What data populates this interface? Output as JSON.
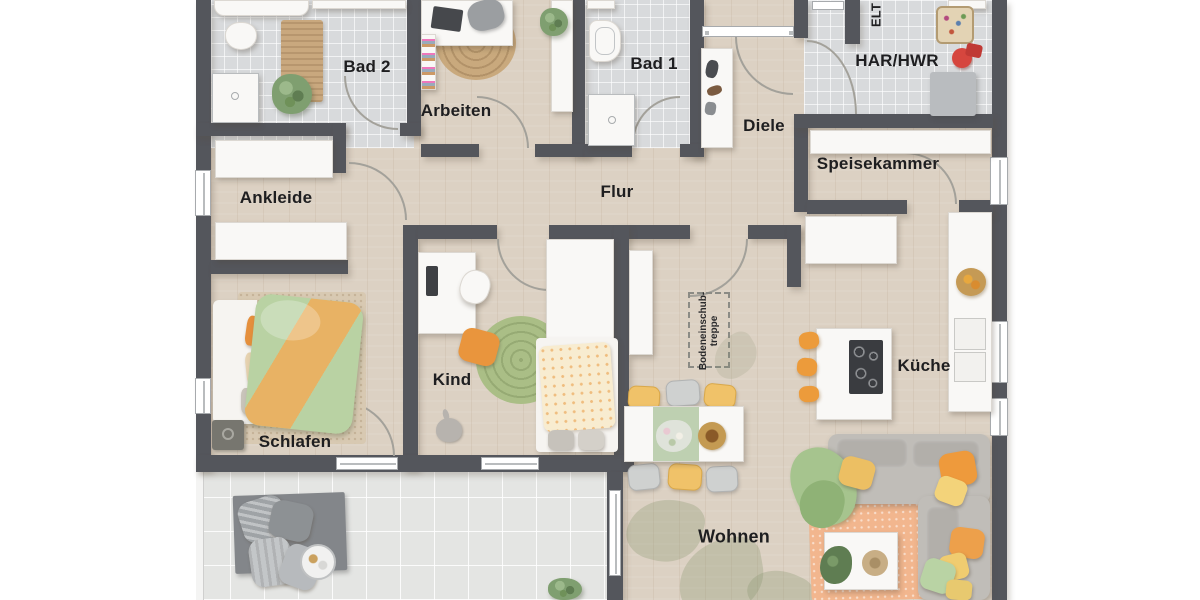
{
  "rooms": {
    "bad2": "Bad 2",
    "arbeiten": "Arbeiten",
    "bad1": "Bad 1",
    "diele": "Diele",
    "elt": "ELT",
    "har": "HAR/HWR",
    "speisekammer": "Speisekammer",
    "ankleide": "Ankleide",
    "flur": "Flur",
    "kind": "Kind",
    "schlafen": "Schlafen",
    "kueche": "Küche",
    "wohnen": "Wohnen"
  },
  "annotations": {
    "attic_stairs_line1": "Bodeneinschub-",
    "attic_stairs_line2": "treppe"
  },
  "colors": {
    "wall": "#54565c",
    "wood_floor": "#dcd1c3",
    "tile_floor": "#d8dadc",
    "terrace_floor": "#e4e5e3",
    "accent_orange": "#ec9b3d",
    "accent_yellow": "#f0c269",
    "accent_green": "#a9c791",
    "rug_orange": "#f2b68e"
  }
}
